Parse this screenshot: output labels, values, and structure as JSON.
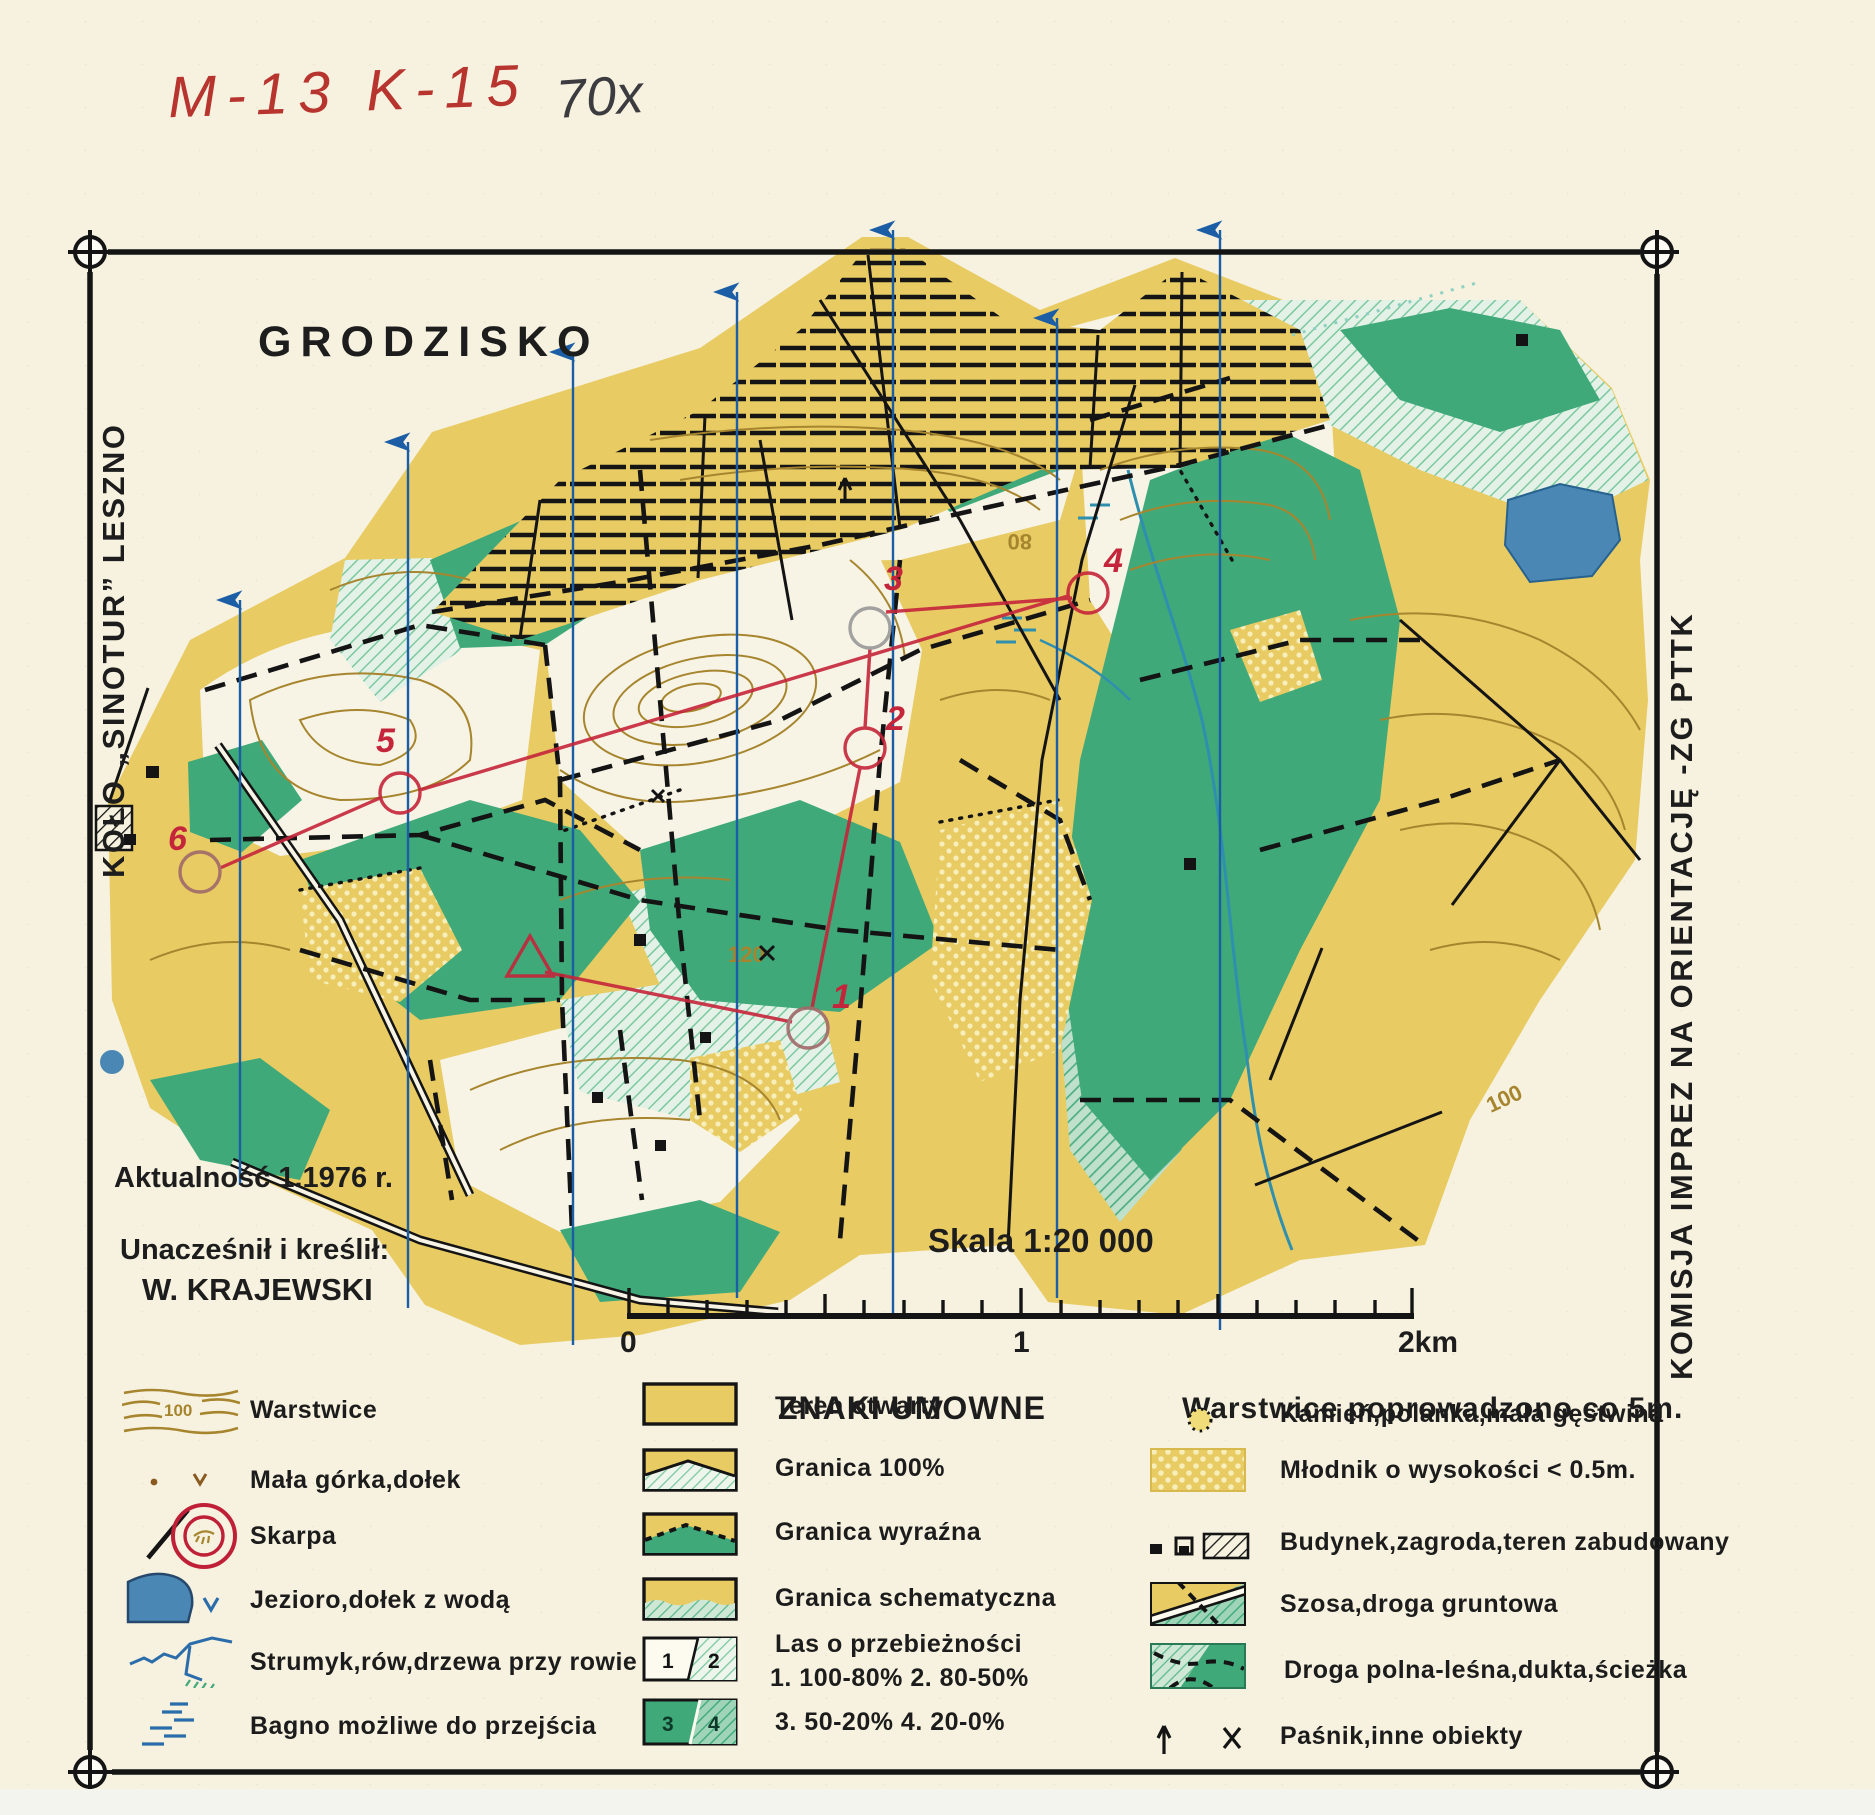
{
  "annotations": {
    "code": "M-13 K-15",
    "note": "70x"
  },
  "header": {
    "title": "GRODZISKO"
  },
  "side_texts": {
    "left": "KOŁO „SINOTUR” LESZNO",
    "right": "KOMISJA IMPREZ NA ORIENTACJĘ -ZG PTTK"
  },
  "credits": {
    "currency": "Aktualność 1.1976 r.",
    "drafted_label": "Unacześnił i kreślił:",
    "drafted_by": "W. KRAJEWSKI"
  },
  "scale": {
    "label": "Skala 1:20 000",
    "tick_start": "0",
    "tick_mid": "1",
    "tick_end": "2km"
  },
  "legend": {
    "title": "ZNAKI UMOWNE",
    "contour_note": "Warstwice poprowadzono co 5m.",
    "col_left": [
      {
        "icon": "contour-lines-icon",
        "label": "Warstwice"
      },
      {
        "icon": "knoll-pit-icon",
        "label": "Mała górka,dołek"
      },
      {
        "icon": "scarp-icon",
        "label": "Skarpa"
      },
      {
        "icon": "lake-icon",
        "label": "Jezioro,dołek z wodą"
      },
      {
        "icon": "stream-icon",
        "label": "Strumyk,rów,drzewa przy rowie"
      },
      {
        "icon": "marsh-icon",
        "label": "Bagno możliwe do przejścia"
      }
    ],
    "col_mid": [
      {
        "icon": "open-terrain-swatch",
        "label": "Teren otwarty"
      },
      {
        "icon": "boundary-100-swatch",
        "label": "Granica 100%"
      },
      {
        "icon": "boundary-distinct-swatch",
        "label": "Granica wyraźna"
      },
      {
        "icon": "boundary-schematic-swatch",
        "label": "Granica schematyczna"
      },
      {
        "icon": "runnability-12-swatch",
        "label": "Las o przebieżności",
        "sublabel": "1. 100-80%   2. 80-50%",
        "cell1": "1",
        "cell2": "2"
      },
      {
        "icon": "runnability-34-swatch",
        "label": "3. 50-20%   4. 20-0%",
        "cell1": "3",
        "cell2": "4"
      }
    ],
    "col_right": [
      {
        "icon": "stone-clearing-icon",
        "label": "Kamień,polanka,mała gęstwina"
      },
      {
        "icon": "young-forest-swatch",
        "label": "Młodnik o wysokości < 0.5m."
      },
      {
        "icon": "building-icon",
        "label": "Budynek,zagroda,teren zabudowany"
      },
      {
        "icon": "road-swatch",
        "label": "Szosa,droga gruntowa"
      },
      {
        "icon": "forest-path-swatch",
        "label": "Droga polna-leśna,dukta,ścieżka"
      },
      {
        "icon": "feeder-objects-icon",
        "label": "Paśnik,inne obiekty"
      }
    ],
    "contour_icon_label": "100"
  },
  "map": {
    "controls": [
      "1",
      "2",
      "3",
      "4",
      "5",
      "6"
    ],
    "contour_labels": {
      "l80": "80",
      "l100": "100",
      "l120": "120"
    }
  },
  "colors": {
    "paper": "#f6f2df",
    "open_yellow": "#e8cb63",
    "forest_green": "#3fa97a",
    "light_green": "#cfe8d6",
    "lake_blue": "#4a87b4",
    "stream_teal": "#2f8fae",
    "north_blue": "#1b5ea6",
    "contour_brown": "#a7852e",
    "course_red": "#c5253a",
    "frame_black": "#141414"
  }
}
